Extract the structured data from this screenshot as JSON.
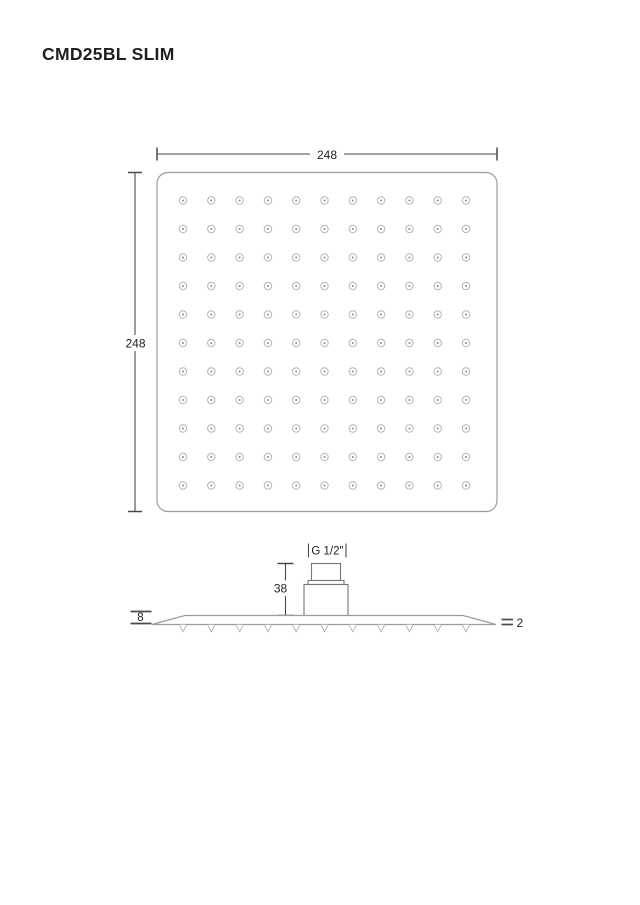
{
  "title": "CMD25BL SLIM",
  "top_view": {
    "width_dim": "248",
    "height_dim": "248",
    "grid_rows": 11,
    "grid_cols": 11
  },
  "side_view": {
    "connector_thread_label": "G 1/2\"",
    "connector_height_dim": "38",
    "body_thickness_dim": "8",
    "edge_thickness_dim": "2",
    "nozzle_count": 11
  },
  "colors": {
    "background": "#ffffff",
    "text": "#1f1f1f",
    "line": "#4a4a4a",
    "outline_mid": "#767676",
    "outline_light": "#9c9c9c",
    "hole_ring": "#b5b5b5",
    "hole_dot": "#8c8c8c"
  }
}
